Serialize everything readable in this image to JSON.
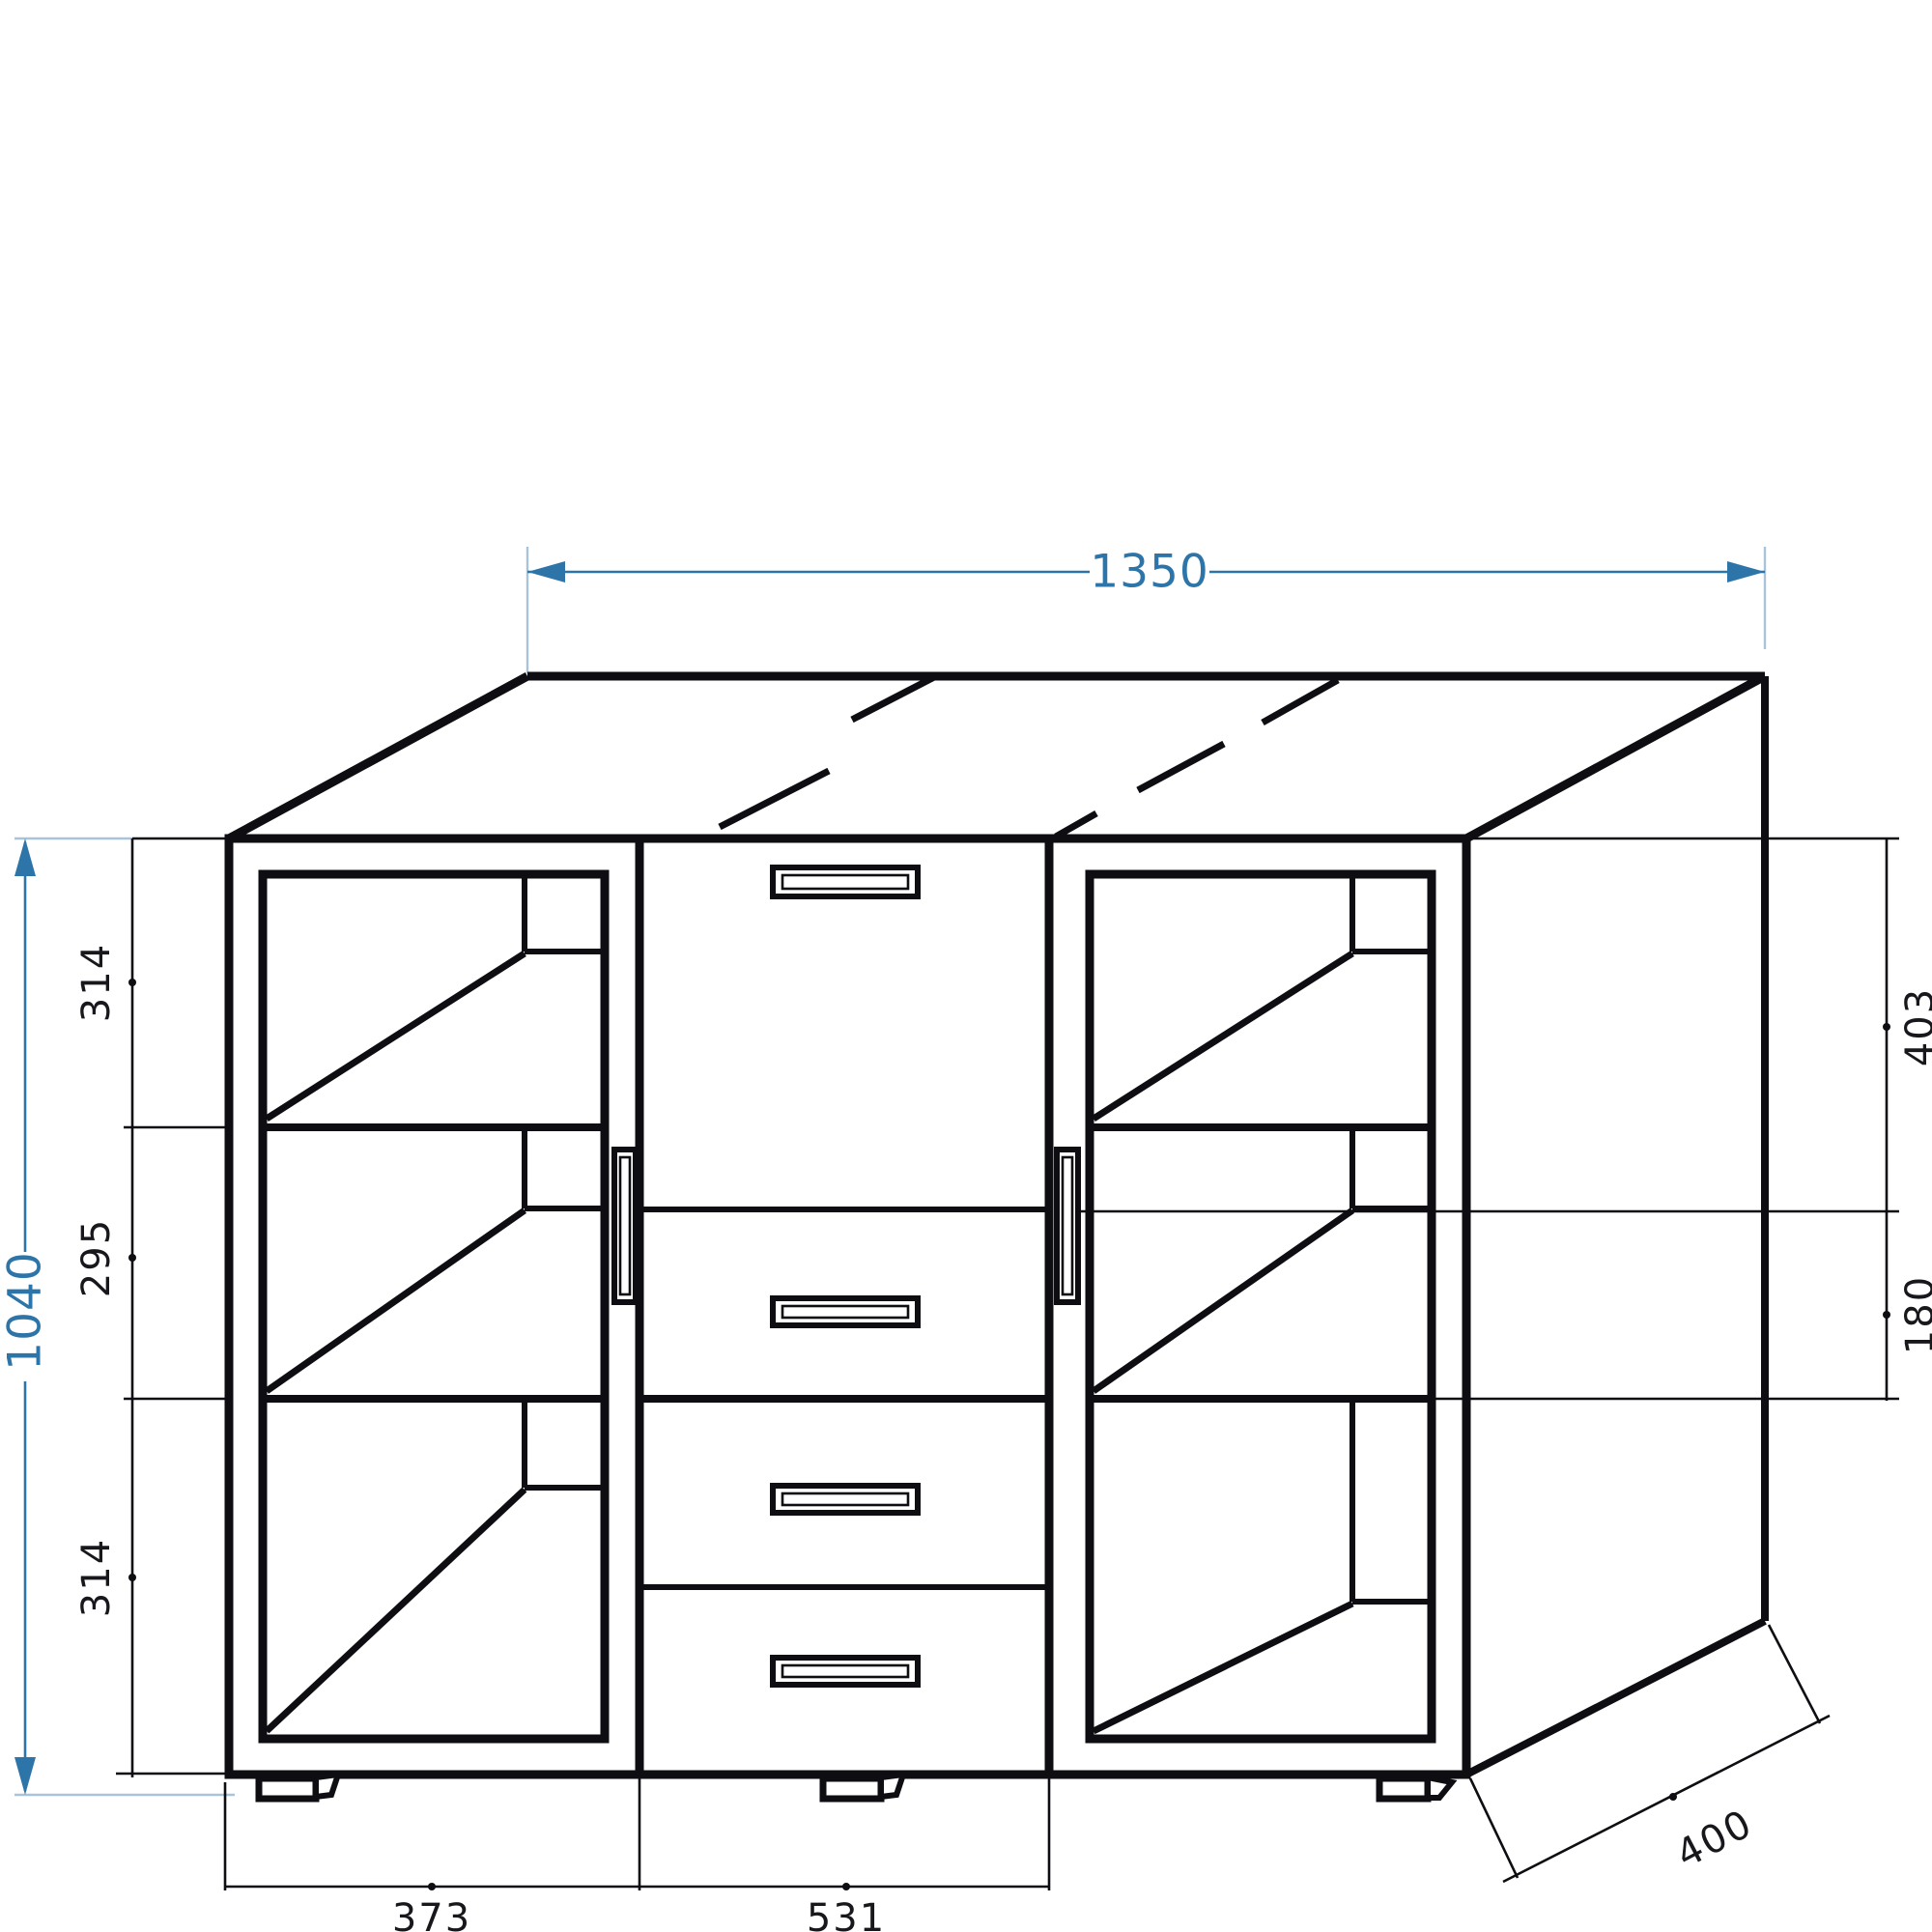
{
  "drawing": {
    "type": "furniture technical drawing (sideboard with two glass doors and four drawers)",
    "dimensions": {
      "overall_width": "1350",
      "overall_height": "1040",
      "overall_depth": "400",
      "left_compartments": [
        "314",
        "295",
        "314"
      ],
      "center_sections": [
        "403",
        "180"
      ],
      "bottom_widths": [
        "373",
        "531"
      ]
    },
    "colors": {
      "dimension_blue": "#2d75a9",
      "extension_light_blue": "#a9c3d8",
      "line_black": "#0d0d12",
      "background": "#ffffff"
    }
  }
}
